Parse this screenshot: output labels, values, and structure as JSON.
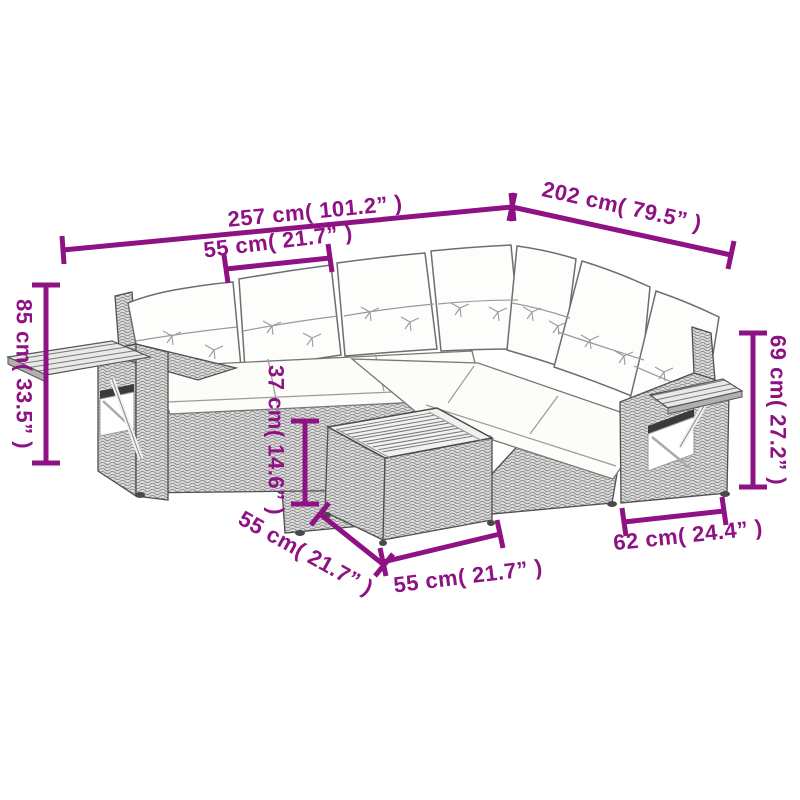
{
  "diagram": {
    "accent_color": "#8E1283",
    "dimensions": {
      "total_width_label": "257 cm( 101.2” )",
      "total_depth_label": "202 cm( 79.5” )",
      "seat_width_label": "55 cm( 21.7” )",
      "back_height_label": "85 cm( 33.5” )",
      "armrest_height_label": "69 cm( 27.2” )",
      "table_height_label": "37 cm( 14.6” )",
      "table_side_label": "55 cm( 21.7” )",
      "table_front_label": "55 cm( 21.7” )",
      "armrest_module_depth_label": "62 cm( 24.4” )"
    }
  }
}
